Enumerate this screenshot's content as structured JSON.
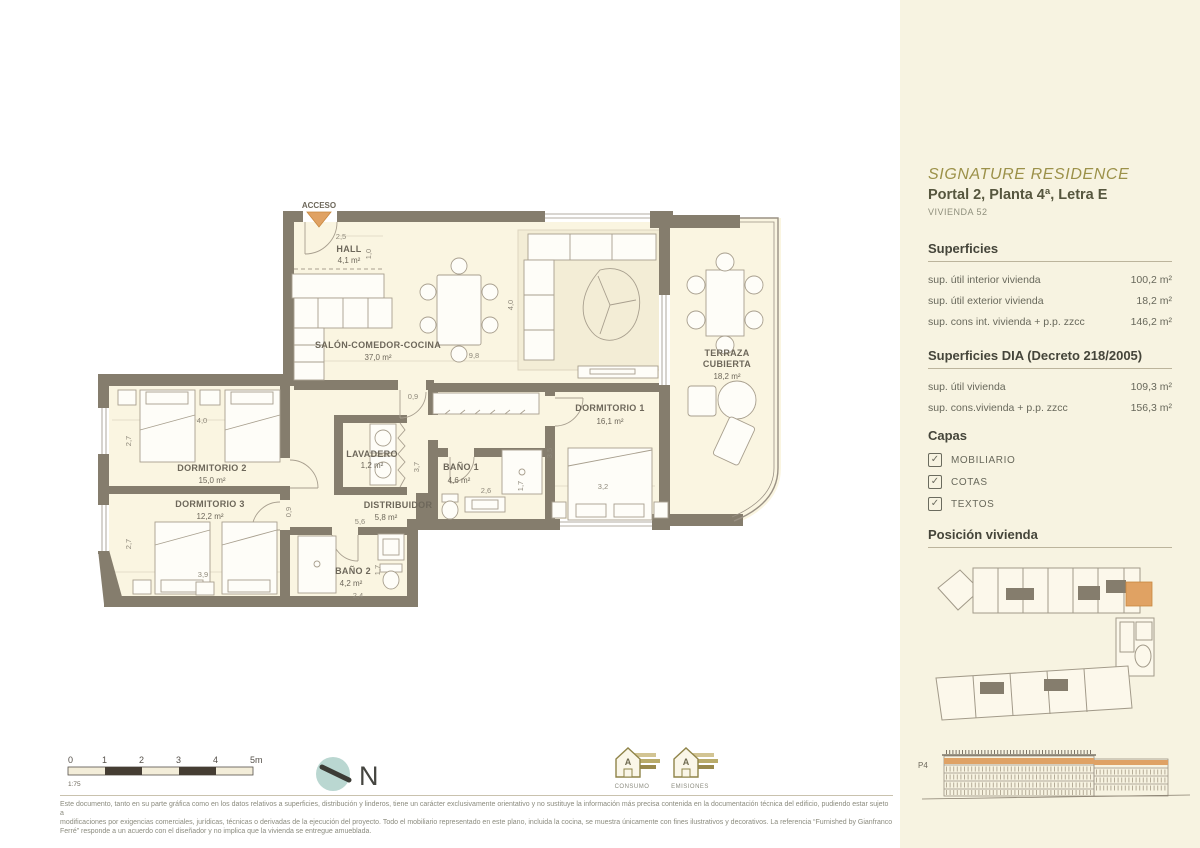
{
  "sidebar": {
    "project_title": "SIGNATURE RESIDENCE",
    "unit_title": "Portal 2, Planta 4ª, Letra E",
    "unit_subtitle": "VIVIENDA 52",
    "superficies": {
      "heading": "Superficies",
      "rows": [
        {
          "label": "sup. útil interior vivienda",
          "value": "100,2 m²"
        },
        {
          "label": "sup. útil exterior vivienda",
          "value": "18,2 m²"
        },
        {
          "label": "sup. cons int. vivienda + p.p. zzcc",
          "value": "146,2 m²"
        }
      ]
    },
    "superficies_dia": {
      "heading": "Superficies DIA (Decreto 218/2005)",
      "rows": [
        {
          "label": "sup. útil  vivienda",
          "value": "109,3 m²"
        },
        {
          "label": "sup. cons.vivienda + p.p. zzcc",
          "value": "156,3 m²"
        }
      ]
    },
    "capas": {
      "heading": "Capas",
      "check_glyph": "✓",
      "items": [
        {
          "label": "MOBILIARIO",
          "checked": true
        },
        {
          "label": "COTAS",
          "checked": true
        },
        {
          "label": "TEXTOS",
          "checked": true
        }
      ]
    },
    "posicion_heading": "Posición vivienda",
    "elevation_floor_label": "P4"
  },
  "plan": {
    "acceso": "ACCESO",
    "rooms": {
      "hall": {
        "name": "HALL",
        "area": "4,1 m²"
      },
      "salon": {
        "name": "SALÓN-COMEDOR-COCINA",
        "area": "37,0 m²"
      },
      "terraza": {
        "name1": "TERRAZA",
        "name2": "CUBIERTA",
        "area": "18,2 m²"
      },
      "dorm1": {
        "name": "DORMITORIO 1",
        "area": "16,1 m²"
      },
      "dorm2": {
        "name": "DORMITORIO 2",
        "area": "15,0 m²"
      },
      "dorm3": {
        "name": "DORMITORIO 3",
        "area": "12,2 m²"
      },
      "bano1": {
        "name": "BAÑO 1",
        "area": "4,6 m²"
      },
      "bano2": {
        "name": "BAÑO 2",
        "area": "4,2 m²"
      },
      "lavadero": {
        "name": "LAVADERO",
        "area": "1,2 m²"
      },
      "distribuidor": {
        "name": "DISTRIBUIDOR",
        "area": "5,8 m²"
      }
    },
    "dims": {
      "hall_w": "2,5",
      "hall_d": "1,0",
      "salon_h": "4,0",
      "salon_w": "9,8",
      "door_salon": "0,9",
      "distrib_w": "5,6",
      "distrib_h": "3,7",
      "bano1_w": "2,6",
      "bano1_h": "1,7",
      "dorm1_w": "3,2",
      "dorm1_h": "3,5",
      "dorm2_w": "4,0",
      "dorm2_h": "2,7",
      "dorm3_w": "3,9",
      "dorm3_h": "2,7",
      "dorm3_door": "0,9",
      "bano2_w": "2,4",
      "bano2_h": "1,7"
    }
  },
  "footer": {
    "scale": {
      "ticks": [
        "0",
        "1",
        "2",
        "3",
        "4",
        "5m"
      ],
      "ratio": "1:75"
    },
    "compass_label": "N",
    "energy": {
      "consumo": "CONSUMO",
      "emisiones": "EMISIONES"
    },
    "disclaimer": [
      "Este documento, tanto en su parte gráfica como en los datos relativos a superficies, distribución y linderos, tiene un carácter exclusivamente orientativo y no sustituye la información más precisa contenida en la documentación técnica del edificio, pudiendo estar sujeto a",
      "modificaciones por exigencias comerciales, jurídicas, técnicas o derivadas de la ejecución del proyecto. Todo el mobiliario representado en este plano, incluida la cocina, se muestra únicamente con fines ilustrativos y decorativos. La referencia “Furnished by Gianfranco",
      "Ferré” responde a un acuerdo con el diseñador y no implica que la vivienda se entregue amueblada."
    ]
  },
  "colors": {
    "accent_orange": "#e0a263",
    "wall": "#857d6d",
    "floor_cream": "#faf5e1",
    "sidebar_cream": "#f7f3e1",
    "title_olive": "#9c9149",
    "compass_teal": "#bad7d1"
  }
}
